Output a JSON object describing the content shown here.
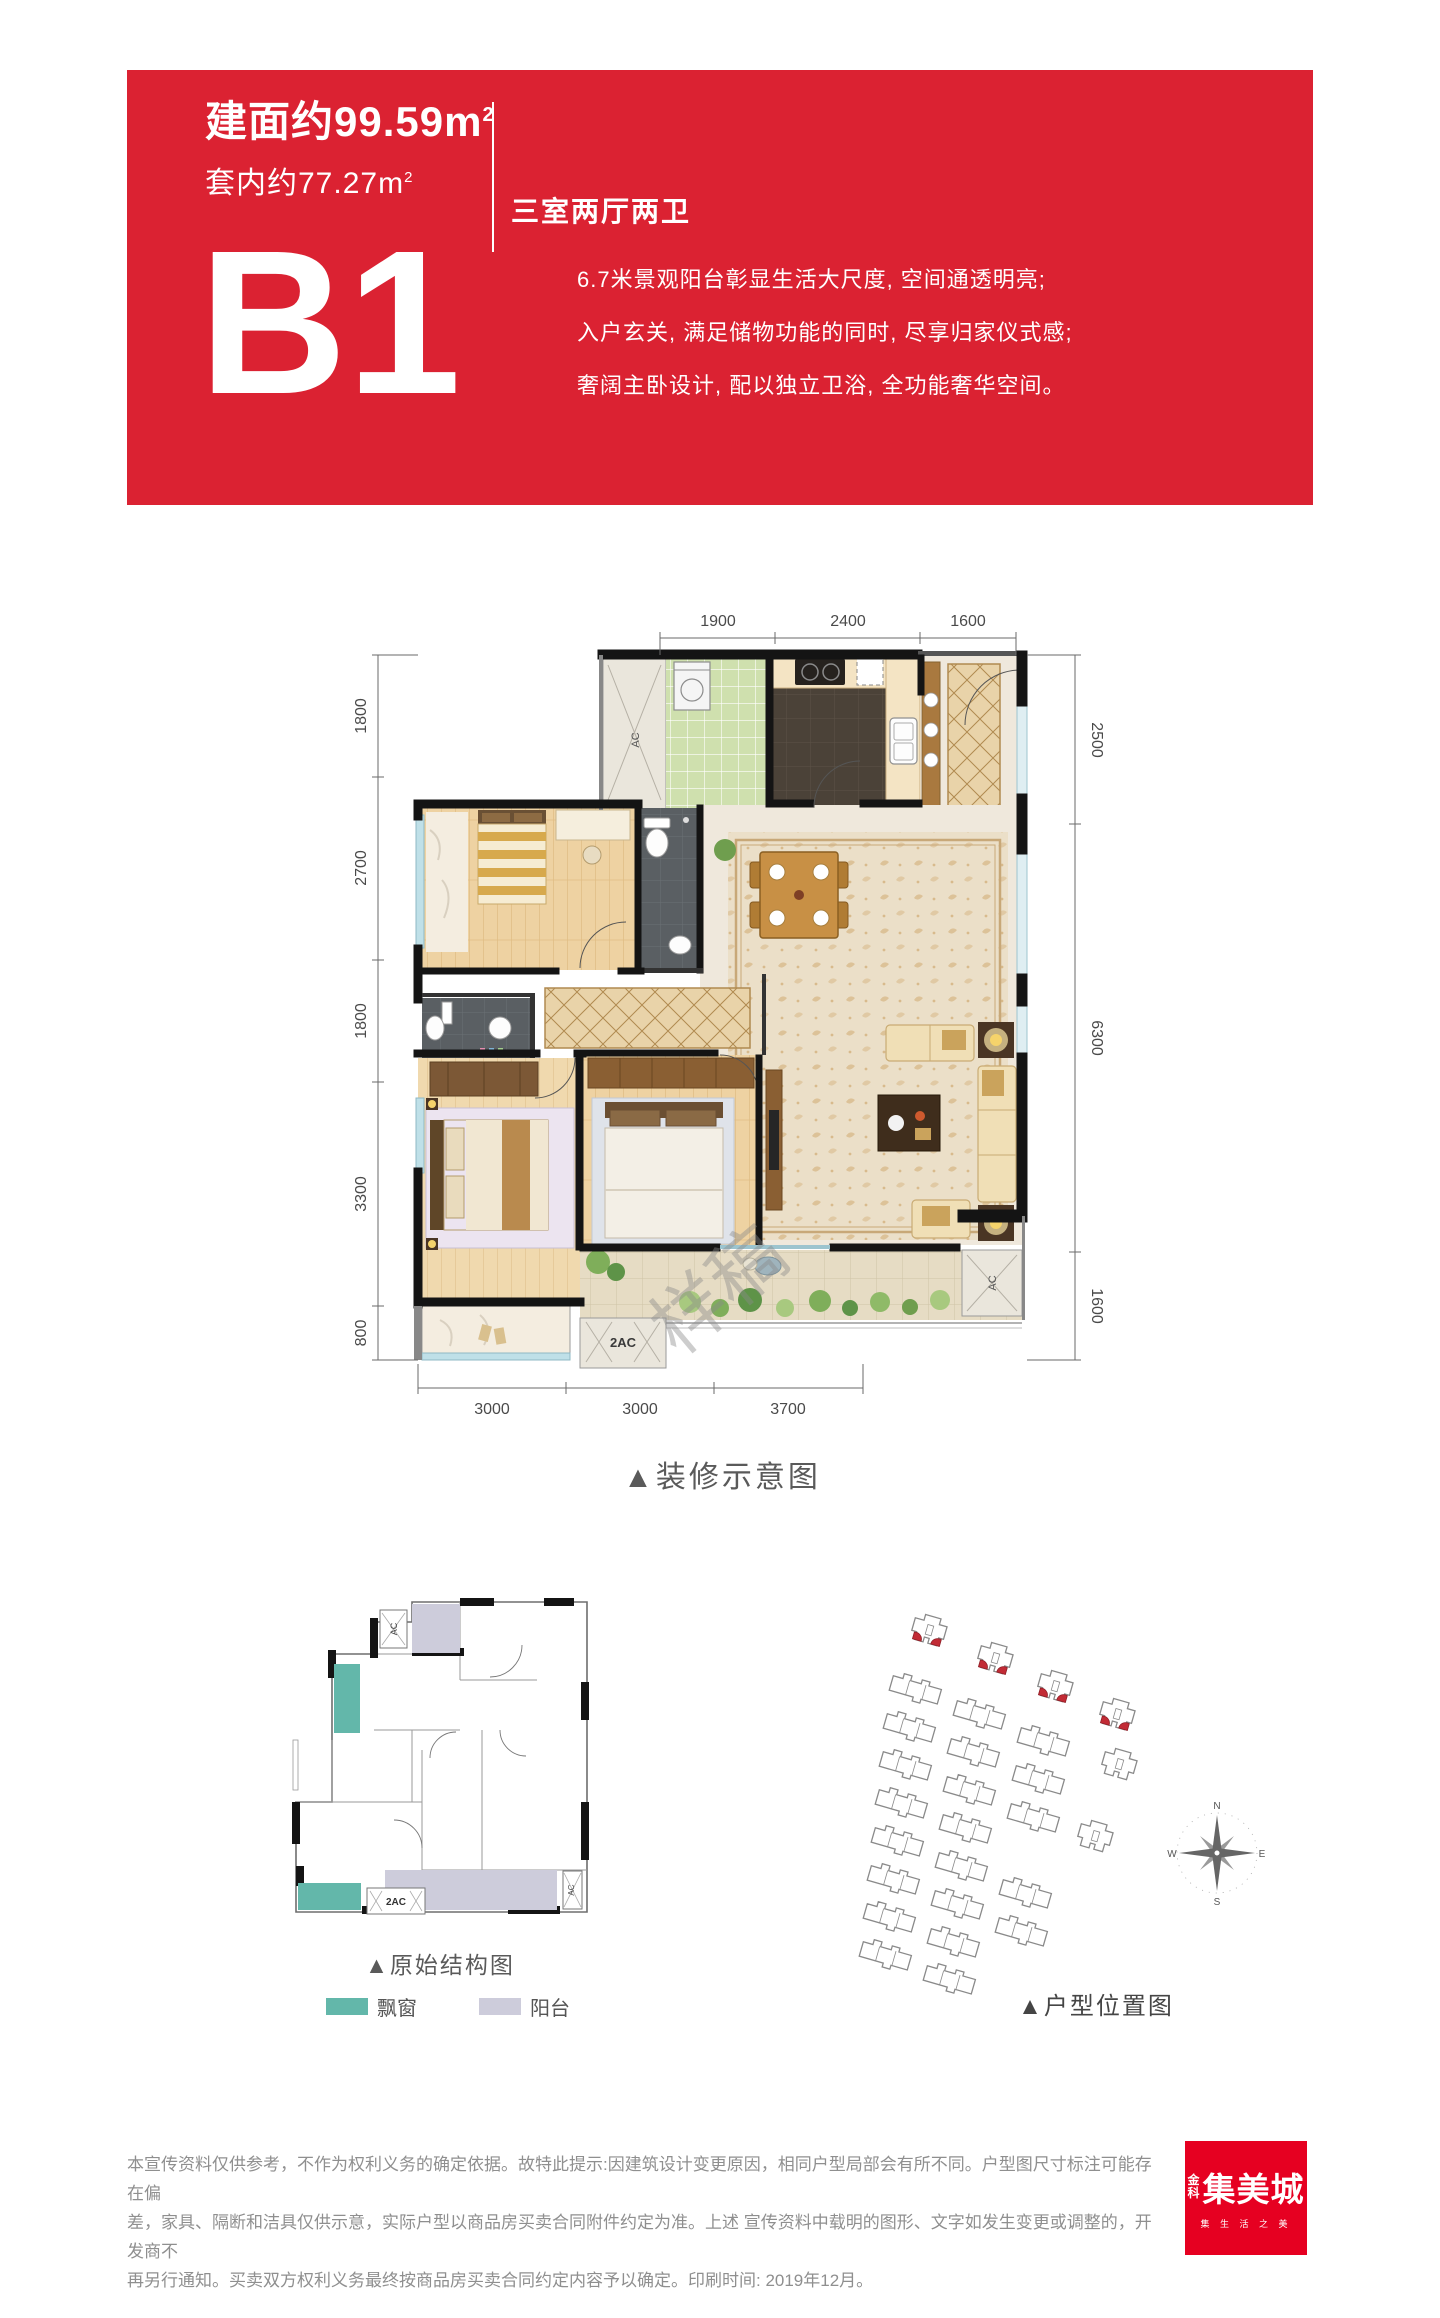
{
  "colors": {
    "banner_red": "#DB2232",
    "logo_red": "#E60021",
    "bay_window_teal": "#63B7AA",
    "balcony_lavender": "#CDCCDB",
    "site_highlight_red": "#C22B35"
  },
  "banner": {
    "area_built": "建面约99.59m",
    "area_built_sup": "2",
    "area_inner": "套内约77.27m",
    "area_inner_sup": "2",
    "layout_type": "三室两厅两卫",
    "unit_name": "B1",
    "description_lines": [
      "6.7米景观阳台彰显生活大尺度, 空间通透明亮;",
      "入户玄关, 满足储物功能的同时, 尽享归家仪式感;",
      "奢阔主卧设计, 配以独立卫浴, 全功能奢华空间。"
    ]
  },
  "floor_plan": {
    "caption": "▲装修示意图",
    "watermark": "样稿",
    "dims_top": [
      "1900",
      "2400",
      "1600"
    ],
    "dims_left": [
      "1800",
      "2700",
      "1800",
      "3300",
      "800"
    ],
    "dims_right": [
      "2500",
      "6300",
      "1600"
    ],
    "dims_bottom": [
      "3000",
      "3000",
      "3700"
    ],
    "ac_top": "AC",
    "ac_right": "AC",
    "ac_bottom": "2AC"
  },
  "structure_plan": {
    "caption": "▲原始结构图",
    "ac_top": "AC",
    "ac_bottom": "2AC",
    "ac_right": "AC",
    "legend": [
      {
        "label": "飘窗",
        "color": "#63B7AA"
      },
      {
        "label": "阳台",
        "color": "#CDCCDB"
      }
    ]
  },
  "site_map": {
    "caption": "▲户型位置图",
    "compass": {
      "n": "N",
      "e": "E",
      "s": "S",
      "w": "W"
    }
  },
  "footer": {
    "disclaimer_lines": [
      "本宣传资料仅供参考，不作为权利义务的确定依据。故特此提示:因建筑设计变更原因，相同户型局部会有所不同。户型图尺寸标注可能存在偏",
      "差，家具、隔断和洁具仅供示意，实际户型以商品房买卖合同附件约定为准。上述  宣传资料中载明的图形、文字如发生变更或调整的，开发商不",
      "再另行通知。买卖双方权利义务最终按商品房买卖合同约定内容予以确定。印刷时间: 2019年12月。"
    ],
    "logo": {
      "brand_char_1": "金",
      "brand_char_2": "科",
      "name": "集美城",
      "slogan": "集 生 活 之 美"
    }
  }
}
